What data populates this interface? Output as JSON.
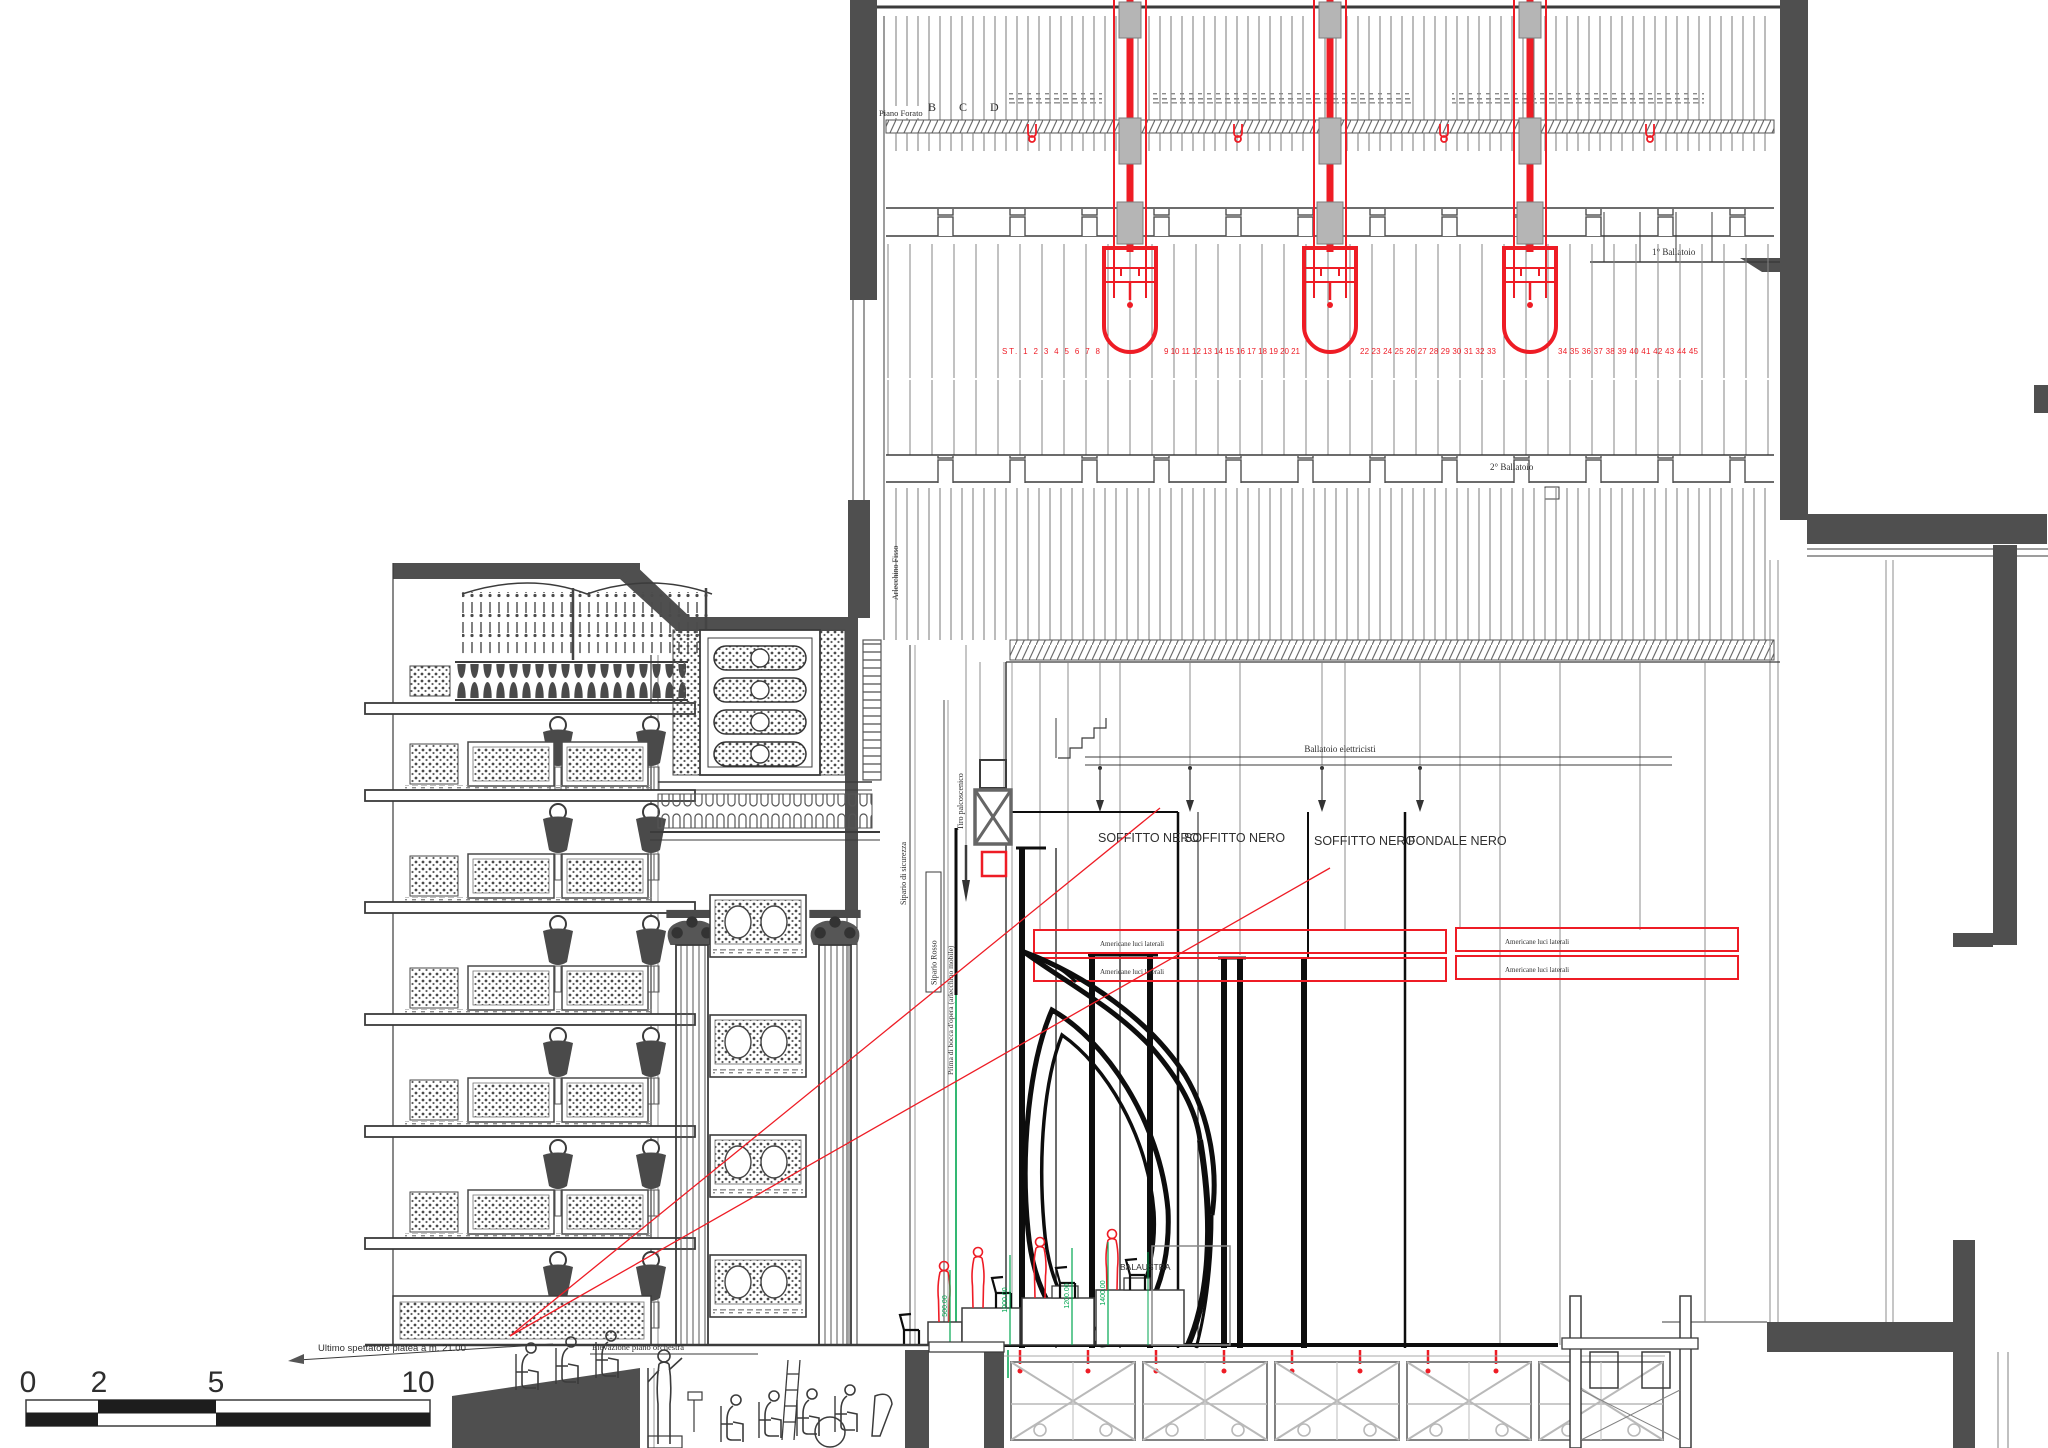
{
  "meta": {
    "drawing_type": "Longitudinal section of a theater — stage tower, rigging and auditorium (CAD)"
  },
  "colors": {
    "accent_red": "#ee1c25",
    "dimension_green": "#00a650",
    "wall_gray": "#4f4f4f",
    "line_dark": "#3b3b3b"
  },
  "fly_tower": {
    "grid_floor_label": "Piano Forato",
    "grid_column_letters": "B C D",
    "gallery_1_label": "1° Ballatoio",
    "gallery_2_label": "2° Ballatoio",
    "hoist_numbers_1": "ST. 1 2 3 4 5 6 7 8",
    "hoist_numbers_2": "9 10 11 12 13 14 15 16 17 18 19 20 21",
    "hoist_numbers_3": "22 23 24 25 26 27 28 29 30 31 32 33",
    "hoist_numbers_4": "34 35 36 37 38 39 40 41 42 43 44 45"
  },
  "stage": {
    "electricians_gallery_label": "Ballatoio elettricisti",
    "ceiling_labels": [
      "SOFFITTO NERO",
      "SOFFITTO NERO",
      "SOFFITTO NERO",
      "FONDALE NERO"
    ],
    "side_lights_label": "Americane luci laterali",
    "balustrade_label": "BALAUSTRA",
    "platform_heights": [
      "500.00",
      "1000.00",
      "1200.00",
      "1400.00"
    ],
    "curtains": {
      "fixed_border": "Arlecchino Fisso",
      "safety_curtain": "Sipario di sicurezza",
      "red_curtain": "Sipario Rosso",
      "house_border": "Prima di bocca d'opera (arlecchino mobile)",
      "stage_hoist": "Tiro palcoscenico"
    }
  },
  "auditorium": {
    "sightline_note": "Ultimo spettatore platea a m. 21.00",
    "orchestra_note": "Elevazione piano orchestra"
  },
  "scale_bar": {
    "ticks": [
      "0",
      "2",
      "5",
      "10"
    ]
  }
}
